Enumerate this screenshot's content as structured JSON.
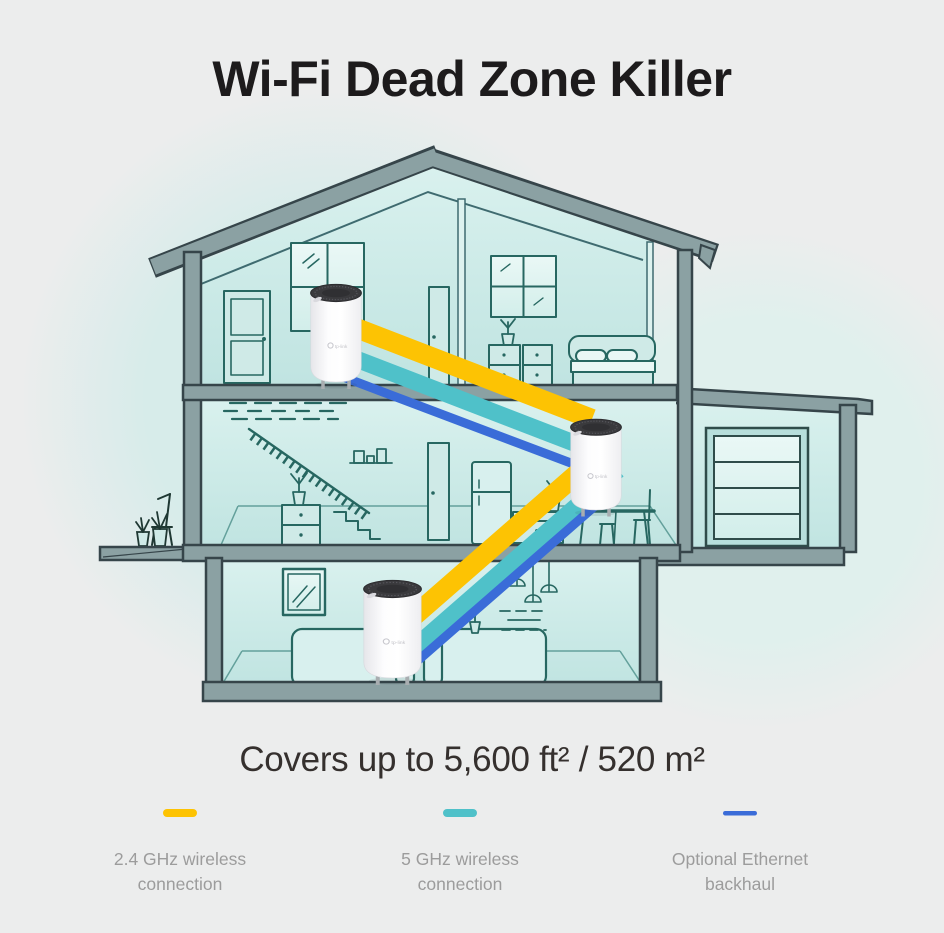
{
  "header": {
    "title": "Wi-Fi Dead Zone Killer"
  },
  "coverage": {
    "text": "Covers up to 5,600 ft² / 520 m²"
  },
  "legend": {
    "items": [
      {
        "id": "wireless-24ghz",
        "color": "#FDC303",
        "lines": [
          "2.4 GHz wireless",
          "connection"
        ]
      },
      {
        "id": "wireless-5ghz",
        "color": "#4FC1C9",
        "lines": [
          "5 GHz wireless",
          "connection"
        ]
      },
      {
        "id": "ethernet-backhaul",
        "color": "#3A6CD8",
        "lines": [
          "Optional Ethernet",
          "backhaul"
        ]
      }
    ]
  },
  "diagram": {
    "units": [
      {
        "id": "deco-unit-attic"
      },
      {
        "id": "deco-unit-living-room"
      },
      {
        "id": "deco-unit-ground-floor"
      }
    ],
    "connections": [
      {
        "from": "deco-unit-attic",
        "to": "deco-unit-living-room",
        "bands": [
          "2.4 GHz",
          "5 GHz",
          "Ethernet"
        ]
      },
      {
        "from": "deco-unit-living-room",
        "to": "deco-unit-ground-floor",
        "bands": [
          "2.4 GHz",
          "5 GHz",
          "Ethernet"
        ]
      }
    ],
    "colors": {
      "structure": "#8BA1A3",
      "outline": "#36454A",
      "interior": "#C8E9E6",
      "lineart": "#276761",
      "background": "#ECEDED",
      "blob": "#D6ECEA",
      "deco_body": "#FFFFFF",
      "deco_cap": "#3A3A3D"
    }
  }
}
